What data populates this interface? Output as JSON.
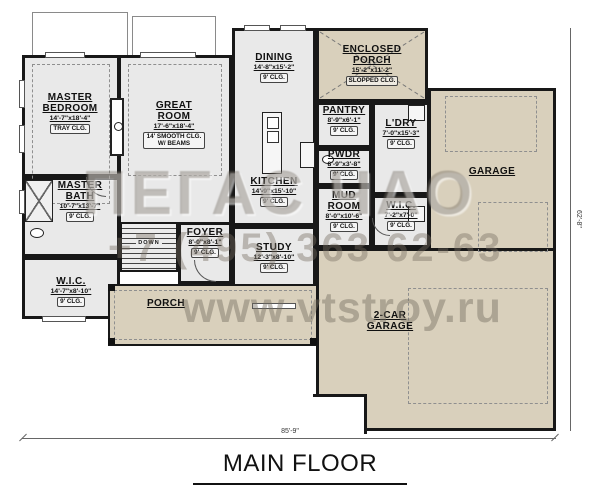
{
  "title": "MAIN FLOOR",
  "dimensions": {
    "width": "85'-9\"",
    "height": "62'-8\""
  },
  "watermark": {
    "logo": "ПЕГАС ЧАО",
    "phone": "+7 (495) 363 62-63",
    "site": "www.vtstroy.ru"
  },
  "rooms": {
    "master_bedroom": {
      "name": "MASTER BEDROOM",
      "dim": "14'-7\"x18'-4\"",
      "clg": "TRAY CLG."
    },
    "great_room": {
      "name": "GREAT ROOM",
      "dim": "17'-6\"x18'-4\"",
      "clg": "14' SMOOTH CLG. W/ BEAMS"
    },
    "dining": {
      "name": "DINING",
      "dim": "14'-8\"x15'-2\"",
      "clg": "9' CLG."
    },
    "kitchen": {
      "name": "KITCHEN",
      "dim": "14'-9\"x15'-10\"",
      "clg": "9' CLG."
    },
    "enclosed_porch": {
      "name": "ENCLOSED PORCH",
      "dim": "15'-2\"x11'-2\"",
      "clg": "SLOPPED CLG."
    },
    "pantry": {
      "name": "PANTRY",
      "dim": "8'-9\"x6'-1\"",
      "clg": "9' CLG."
    },
    "powder": {
      "name": "PWDR",
      "dim": "8'-9\"x3'-8\"",
      "clg": "9' CLG."
    },
    "laundry": {
      "name": "L'DRY",
      "dim": "7'-0\"x15'-3\"",
      "clg": "9' CLG."
    },
    "mud_room": {
      "name": "MUD ROOM",
      "dim": "8'-0\"x10'-6\"",
      "clg": "9' CLG."
    },
    "wic_right": {
      "name": "W.I.C.",
      "dim": "7'-2\"x7'-0\"",
      "clg": "9' CLG."
    },
    "master_bath": {
      "name": "MASTER BATH",
      "dim": "10'-7\"x13'-7\"",
      "clg": "9' CLG."
    },
    "wic_left": {
      "name": "W.I.C.",
      "dim": "14'-7\"x8'-10\"",
      "clg": "9' CLG."
    },
    "foyer": {
      "name": "FOYER",
      "dim": "8'-0\"x8'-1\"",
      "clg": "9' CLG."
    },
    "study": {
      "name": "STUDY",
      "dim": "12'-3\"x8'-10\"",
      "clg": "9' CLG."
    },
    "garage": {
      "name": "GARAGE"
    },
    "two_car_garage": {
      "name": "2-CAR GARAGE"
    },
    "porch": {
      "name": "PORCH"
    },
    "stairs": {
      "name": "DOWN"
    }
  }
}
